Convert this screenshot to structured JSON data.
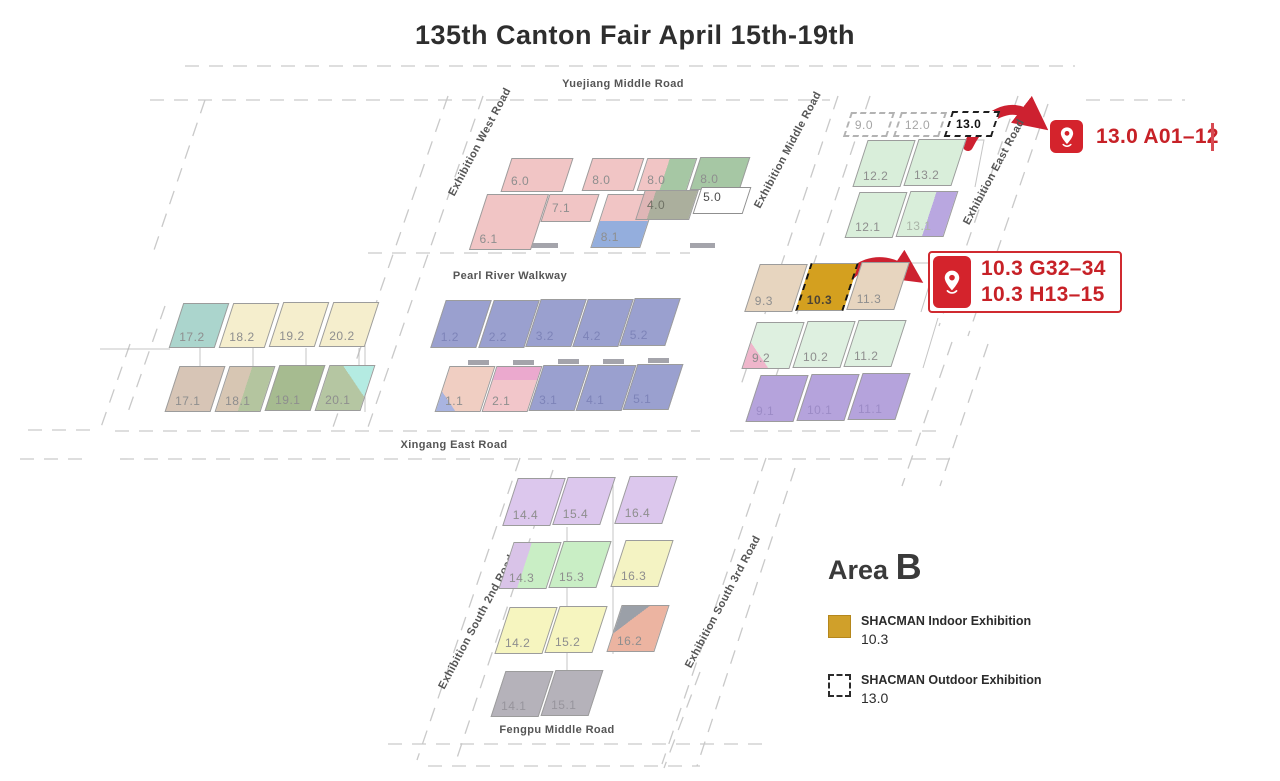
{
  "title": "135th Canton Fair April 15th-19th",
  "colors": {
    "accent_red": "#cd2130",
    "indoor_gold": "#d0a02a",
    "pin_red": "#d4232c"
  },
  "markers": {
    "m1": {
      "text": "13.0 A01–12"
    },
    "m2": {
      "line1": "10.3 G32–34",
      "line2": "10.3 H13–15"
    }
  },
  "legend": {
    "area_word": "Area",
    "area_letter": "B",
    "items": [
      {
        "title": "SHACMAN Indoor Exhibition",
        "value": "10.3",
        "swatch": "gold"
      },
      {
        "title": "SHACMAN Outdoor Exhibition",
        "value": "13.0",
        "swatch": "dashed"
      }
    ]
  },
  "map": {
    "roads": [
      {
        "name": "yuejiang-middle-road",
        "label": "Yuejiang Middle Road",
        "x": 623,
        "y": 84,
        "rot": 0
      },
      {
        "name": "exhibition-west-road",
        "label": "Exhibition West Road",
        "x": 480,
        "y": 142,
        "rot": -62
      },
      {
        "name": "exhibition-middle-road",
        "label": "Exhibition Middle Road",
        "x": 788,
        "y": 150,
        "rot": -62
      },
      {
        "name": "exhibition-east-road",
        "label": "Exhibition East Road",
        "x": 994,
        "y": 172,
        "rot": -62
      },
      {
        "name": "pearl-river-walkway",
        "label": "Pearl River Walkway",
        "x": 510,
        "y": 276,
        "rot": 0
      },
      {
        "name": "xingang-east-road",
        "label": "Xingang East Road",
        "x": 454,
        "y": 445,
        "rot": 0
      },
      {
        "name": "exhibition-south-2nd-road",
        "label": "Exhibition South 2nd Road",
        "x": 477,
        "y": 622,
        "rot": -62
      },
      {
        "name": "exhibition-south-3rd-road",
        "label": "Exhibition South 3rd Road",
        "x": 723,
        "y": 602,
        "rot": -62
      },
      {
        "name": "fengpu-middle-road",
        "label": "Fengpu Middle Road",
        "x": 557,
        "y": 730,
        "rot": 0
      }
    ],
    "halls": [
      {
        "label": "6.0",
        "x": 506,
        "y": 158,
        "w": 62,
        "h": 34,
        "fill": "#f1c5c5"
      },
      {
        "label": "8.0",
        "x": 587,
        "y": 158,
        "w": 52,
        "h": 33,
        "fill": "#f1c5c5"
      },
      {
        "label": "8.0",
        "x": 642,
        "y": 158,
        "w": 50,
        "h": 33,
        "fill": "linear-gradient(90deg,#f1c5c5 0 45%,#a6c7a4 45%)"
      },
      {
        "label": "8.0",
        "x": 695,
        "y": 157,
        "w": 50,
        "h": 33,
        "fill": "#a6c7a4"
      },
      {
        "label": "6.1",
        "x": 478,
        "y": 194,
        "w": 62,
        "h": 56,
        "fill": "#f1c5c5"
      },
      {
        "label": "7.1",
        "x": 545,
        "y": 194,
        "w": 50,
        "h": 28,
        "fill": "#f1c5c5"
      },
      {
        "label": "8.1",
        "x": 599,
        "y": 194,
        "w": 50,
        "h": 54,
        "fill": "linear-gradient(180deg,#f1c5c5 0 50%,#94aedd 50%)"
      },
      {
        "label": "4.0",
        "x": 640,
        "y": 190,
        "w": 54,
        "h": 30,
        "fill": "linear-gradient(90deg,#dfb6b6 0 20%,#abaf9d 20%)",
        "labelColor": "#6f7265"
      },
      {
        "label": "5.0",
        "x": 697,
        "y": 187,
        "w": 50,
        "h": 27,
        "fill": "#ffffff",
        "border": "1.5px solid #8f8f8f",
        "labelPos": "tl",
        "labelColor": "#4c4c4c"
      },
      {
        "label": "9.0",
        "x": 847,
        "y": 112,
        "w": 44,
        "h": 25,
        "fill": "#ffffff",
        "border": "2px dashed #b3b3b3",
        "labelColor": "#a5a5a5"
      },
      {
        "label": "12.0",
        "x": 897,
        "y": 112,
        "w": 46,
        "h": 25,
        "fill": "#ffffff",
        "border": "2px dashed #b3b3b3",
        "labelColor": "#a5a5a5"
      },
      {
        "label": "13.0",
        "x": 948,
        "y": 111,
        "w": 48,
        "h": 26,
        "fill": "#ffffff",
        "border": "2.5px dashed #1f1f1f",
        "labelColor": "#111111",
        "labelBold": true
      },
      {
        "label": "12.2",
        "x": 860,
        "y": 140,
        "w": 48,
        "h": 47,
        "fill": "#d9eeda"
      },
      {
        "label": "13.2",
        "x": 911,
        "y": 139,
        "w": 48,
        "h": 47,
        "fill": "#d9eeda"
      },
      {
        "label": "12.1",
        "x": 852,
        "y": 192,
        "w": 48,
        "h": 46,
        "fill": "#d9eeda"
      },
      {
        "label": "13.1",
        "x": 903,
        "y": 191,
        "w": 48,
        "h": 46,
        "fill": "linear-gradient(90deg,#d9eeda 0 55%,#b9a7e0 55%)",
        "labelColor": "#aab4a8"
      },
      {
        "label": "17.2",
        "x": 176,
        "y": 303,
        "w": 46,
        "h": 45,
        "fill": "#abd5cd"
      },
      {
        "label": "18.2",
        "x": 226,
        "y": 303,
        "w": 46,
        "h": 45,
        "fill": "#f5eecd"
      },
      {
        "label": "19.2",
        "x": 276,
        "y": 302,
        "w": 46,
        "h": 45,
        "fill": "#f5eecd"
      },
      {
        "label": "20.2",
        "x": 326,
        "y": 302,
        "w": 46,
        "h": 45,
        "fill": "#f5eecd"
      },
      {
        "label": "17.1",
        "x": 172,
        "y": 366,
        "w": 46,
        "h": 46,
        "fill": "#d7c5b6"
      },
      {
        "label": "18.1",
        "x": 222,
        "y": 366,
        "w": 46,
        "h": 46,
        "fill": "linear-gradient(90deg,#d7c6b3 0 50%,#b4c59f 50%)"
      },
      {
        "label": "19.1",
        "x": 272,
        "y": 365,
        "w": 46,
        "h": 46,
        "fill": "#a6bb90"
      },
      {
        "label": "20.1",
        "x": 322,
        "y": 365,
        "w": 46,
        "h": 46,
        "fill": "linear-gradient(225deg,#b4ebe2 0 35%,#b5c6a2 35%)"
      },
      {
        "label": "1.2",
        "x": 438,
        "y": 300,
        "w": 46,
        "h": 48,
        "fill": "#9aa0cf",
        "labelColor": "#7d83b8"
      },
      {
        "label": "2.2",
        "x": 486,
        "y": 300,
        "w": 46,
        "h": 48,
        "fill": "#9aa0cf",
        "labelColor": "#7d83b8"
      },
      {
        "label": "3.2",
        "x": 533,
        "y": 299,
        "w": 46,
        "h": 48,
        "fill": "#9aa0cf",
        "labelColor": "#7d83b8"
      },
      {
        "label": "4.2",
        "x": 580,
        "y": 299,
        "w": 46,
        "h": 48,
        "fill": "#9aa0cf",
        "labelColor": "#7d83b8"
      },
      {
        "label": "5.2",
        "x": 627,
        "y": 298,
        "w": 46,
        "h": 48,
        "fill": "#9aa0cf",
        "labelColor": "#7d83b8"
      },
      {
        "label": "1.1",
        "x": 442,
        "y": 366,
        "w": 46,
        "h": 46,
        "fill": "linear-gradient(45deg,#a9b4e0 0 22%,#f0cec2 22%)"
      },
      {
        "label": "2.1",
        "x": 489,
        "y": 366,
        "w": 46,
        "h": 46,
        "fill": "linear-gradient(180deg,#eba9ce 0 30%,#f2c6ca 30%)"
      },
      {
        "label": "3.1",
        "x": 536,
        "y": 365,
        "w": 46,
        "h": 46,
        "fill": "#9aa0cf",
        "labelColor": "#7d83b8"
      },
      {
        "label": "4.1",
        "x": 583,
        "y": 365,
        "w": 46,
        "h": 46,
        "fill": "#9aa0cf",
        "labelColor": "#7d83b8"
      },
      {
        "label": "5.1",
        "x": 630,
        "y": 364,
        "w": 46,
        "h": 46,
        "fill": "#9aa0cf",
        "labelColor": "#7d83b8"
      },
      {
        "label": "9.3",
        "x": 752,
        "y": 264,
        "w": 48,
        "h": 48,
        "fill": "#e7d5bf"
      },
      {
        "label": "10.3",
        "x": 803,
        "y": 263,
        "w": 48,
        "h": 48,
        "fill": "#d4a01f",
        "sideBorder": "2.5px dashed #141414",
        "labelColor": "#4c4335",
        "labelBold": true
      },
      {
        "label": "11.3",
        "x": 854,
        "y": 262,
        "w": 48,
        "h": 48,
        "fill": "#e7d5bf"
      },
      {
        "label": "9.2",
        "x": 749,
        "y": 322,
        "w": 48,
        "h": 47,
        "fill": "linear-gradient(45deg,#efb6cb 0 28%,#def0e0 28%)"
      },
      {
        "label": "10.2",
        "x": 800,
        "y": 321,
        "w": 48,
        "h": 47,
        "fill": "#def0e0"
      },
      {
        "label": "11.2",
        "x": 851,
        "y": 320,
        "w": 48,
        "h": 47,
        "fill": "#def0e0"
      },
      {
        "label": "9.1",
        "x": 753,
        "y": 375,
        "w": 48,
        "h": 47,
        "fill": "#b5a3dc",
        "labelColor": "#9c8bc6"
      },
      {
        "label": "10.1",
        "x": 804,
        "y": 374,
        "w": 48,
        "h": 47,
        "fill": "#b5a3dc",
        "labelColor": "#9c8bc6"
      },
      {
        "label": "11.1",
        "x": 855,
        "y": 373,
        "w": 48,
        "h": 47,
        "fill": "#b5a3dc",
        "labelColor": "#9c8bc6"
      },
      {
        "label": "14.4",
        "x": 510,
        "y": 478,
        "w": 48,
        "h": 48,
        "fill": "#dcc7ed"
      },
      {
        "label": "15.4",
        "x": 560,
        "y": 477,
        "w": 48,
        "h": 48,
        "fill": "#dcc7ed"
      },
      {
        "label": "16.4",
        "x": 622,
        "y": 476,
        "w": 48,
        "h": 48,
        "fill": "#dcc7ed"
      },
      {
        "label": "14.3",
        "x": 506,
        "y": 542,
        "w": 48,
        "h": 47,
        "fill": "linear-gradient(90deg,#d9c3e8 0 38%,#c9eec5 38%)"
      },
      {
        "label": "15.3",
        "x": 556,
        "y": 541,
        "w": 48,
        "h": 47,
        "fill": "#c9eec5"
      },
      {
        "label": "16.3",
        "x": 618,
        "y": 540,
        "w": 48,
        "h": 47,
        "fill": "#f4f3c3"
      },
      {
        "label": "14.2",
        "x": 502,
        "y": 607,
        "w": 48,
        "h": 47,
        "fill": "#f6f5bf"
      },
      {
        "label": "15.2",
        "x": 552,
        "y": 606,
        "w": 48,
        "h": 47,
        "fill": "#f6f5bf"
      },
      {
        "label": "16.2",
        "x": 614,
        "y": 605,
        "w": 48,
        "h": 47,
        "fill": "linear-gradient(135deg,#9ba0a8 0 30%,#ecb4a1 30%)"
      },
      {
        "label": "14.1",
        "x": 498,
        "y": 671,
        "w": 48,
        "h": 46,
        "fill": "#b5b2ba",
        "labelColor": "#97949c"
      },
      {
        "label": "15.1",
        "x": 548,
        "y": 670,
        "w": 48,
        "h": 46,
        "fill": "#b5b2ba",
        "labelColor": "#97949c"
      }
    ]
  }
}
